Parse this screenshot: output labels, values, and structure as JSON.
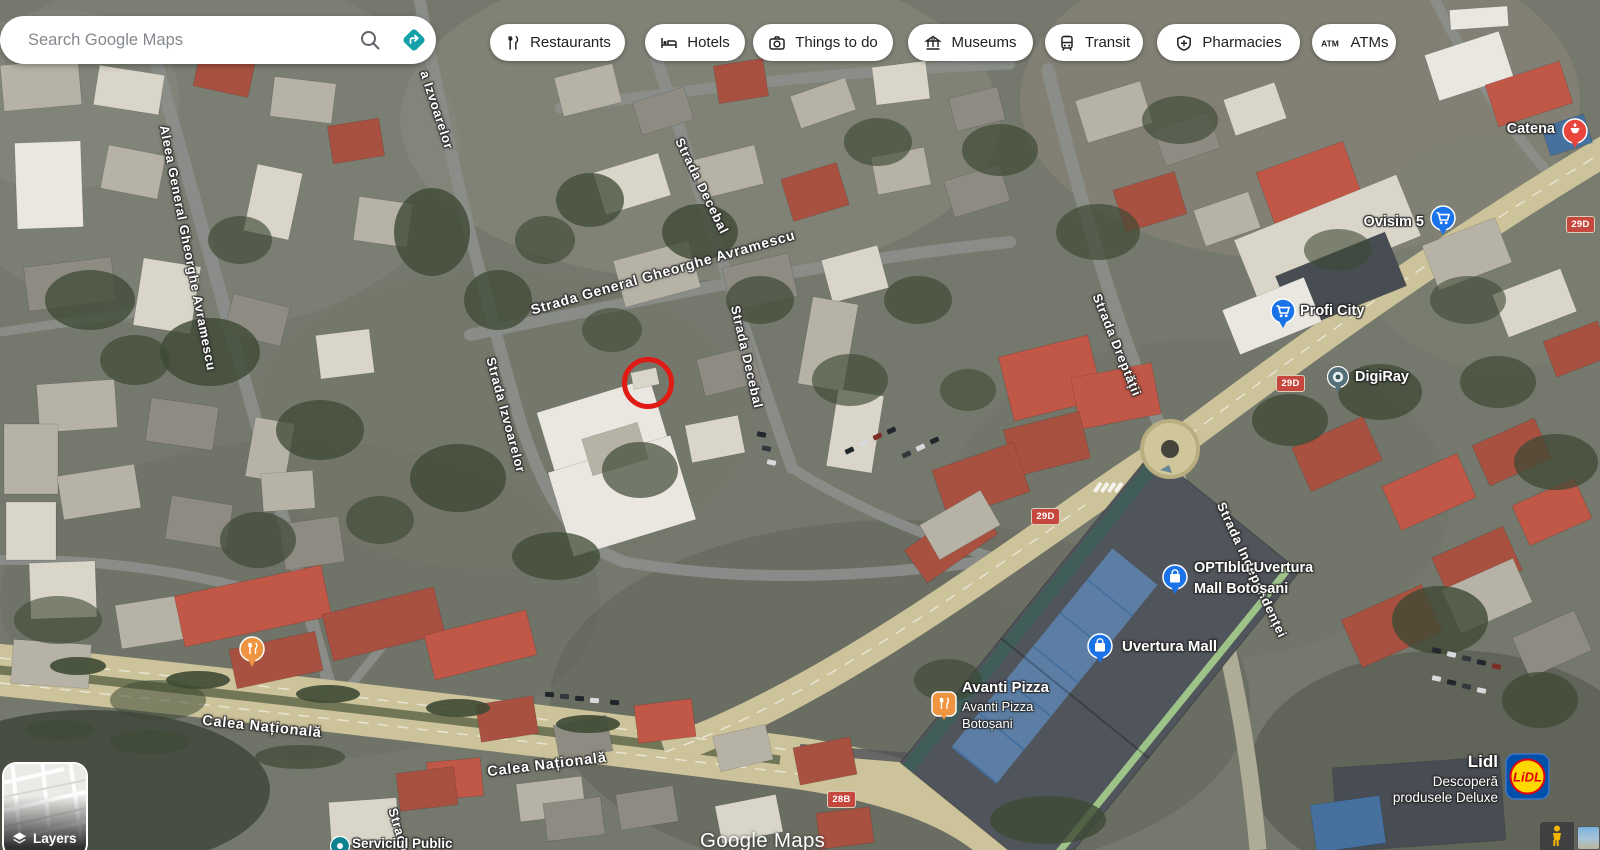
{
  "header": {
    "search": {
      "placeholder": "Search Google Maps"
    },
    "chips": [
      {
        "label": "Restaurants"
      },
      {
        "label": "Hotels"
      },
      {
        "label": "Things to do"
      },
      {
        "label": "Museums"
      },
      {
        "label": "Transit"
      },
      {
        "label": "Pharmacies"
      },
      {
        "label": "ATMs",
        "icon_text": "ATM"
      }
    ]
  },
  "map": {
    "streets": [
      {
        "text": "Aleea General Gheorghe Avramescu"
      },
      {
        "text": "a Izvoarelor"
      },
      {
        "text": "Strada Izvoarelor"
      },
      {
        "text": "Strada Decebal"
      },
      {
        "text": "Strada General Gheorghe Avramescu"
      },
      {
        "text": "Strada Decebal"
      },
      {
        "text": "Strada Dreptății"
      },
      {
        "text": "Strada Independenței"
      },
      {
        "text": "Calea Națională"
      },
      {
        "text": "Calea Națională"
      },
      {
        "text": "Strada"
      }
    ],
    "route_badges": [
      "29D",
      "29D",
      "29D",
      "28B"
    ],
    "pois": {
      "catena": {
        "label": "Catena"
      },
      "ovisim": {
        "label": "Ovisim 5"
      },
      "profi": {
        "label": "Profi City"
      },
      "digiray": {
        "label": "DigiRay"
      },
      "optiblu": {
        "line1": "OPTIblu Uvertura",
        "line2": "Mall Botoșani"
      },
      "uvertura": {
        "label": "Uvertura Mall"
      },
      "avanti": {
        "title": "Avanti Pizza",
        "sub1": "Avanti Pizza",
        "sub2": "Botoșani"
      },
      "lidl": {
        "title": "Lidl",
        "sub1": "Descoperă",
        "sub2": "produsele Deluxe",
        "logo_text": "LiDL"
      },
      "serviciul": {
        "label": "Serviciul Public"
      }
    },
    "watermark": "Google Maps"
  },
  "controls": {
    "layers_label": "Layers"
  },
  "colors": {
    "directions_teal": "#13a0a8",
    "pin_blue": "#1a73e8",
    "pin_red": "#e8453c",
    "pin_orange": "#ef9440",
    "route_badge_red": "#c5473d",
    "lidl_blue": "#0050aa",
    "lidl_yellow": "#ffd800",
    "lidl_red": "#e3000f"
  }
}
